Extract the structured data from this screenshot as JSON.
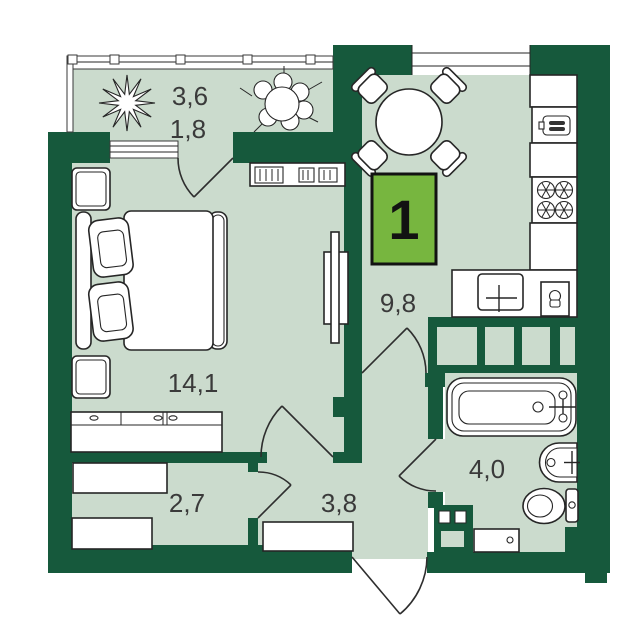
{
  "floor_plan": {
    "apartment_number": "1",
    "labels": {
      "balcony_area": "3,6",
      "balcony_area_reduced": "1,8",
      "bedroom_area": "14,1",
      "kitchen_area": "9,8",
      "hallway_area": "2,7",
      "corridor_area": "3,8",
      "bathroom_area": "4,0"
    },
    "colors": {
      "wall": "#16593C",
      "floor": "#CBDBCD",
      "badge": "#77B63F",
      "label_text": "#3A3A3A"
    }
  }
}
